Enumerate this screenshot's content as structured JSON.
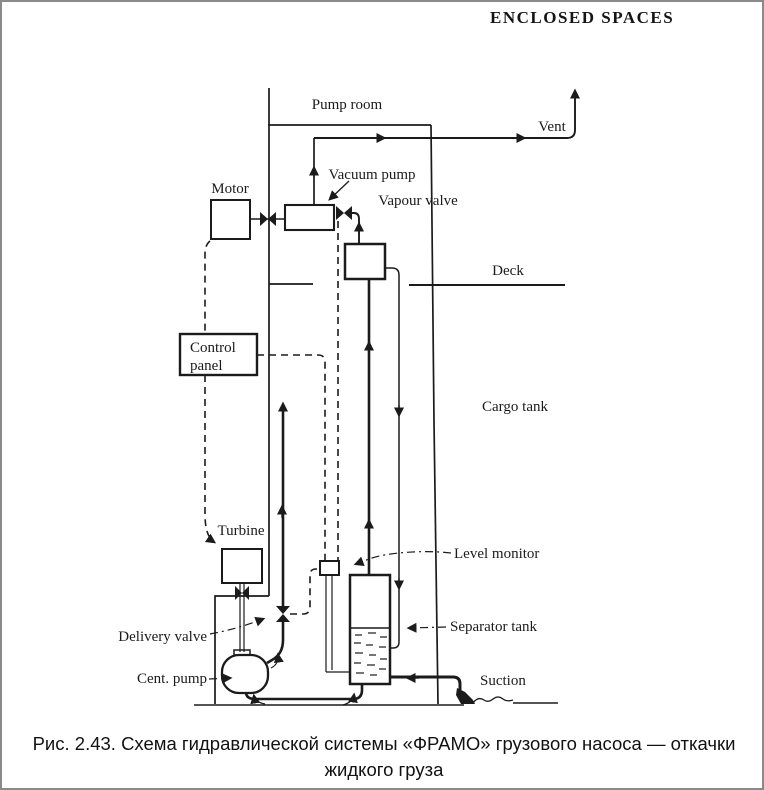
{
  "header": {
    "title": "ENCLOSED SPACES"
  },
  "diagram": {
    "ink_color": "#1b1b1b",
    "labels": {
      "pump_room": "Pump room",
      "vent": "Vent",
      "motor": "Motor",
      "vacuum_pump": "Vacuum pump",
      "vapour_valve": "Vapour valve",
      "deck": "Deck",
      "control_panel_line1": "Control",
      "control_panel_line2": "panel",
      "cargo_tank": "Cargo tank",
      "turbine": "Turbine",
      "level_monitor": "Level monitor",
      "delivery_valve": "Delivery valve",
      "separator_tank": "Separator tank",
      "cent_pump": "Cent. pump",
      "suction": "Suction"
    }
  },
  "caption": {
    "line1": "Рис. 2.43. Схема гидравлической системы «ФРАМО» грузового насоса — откачки",
    "line2": "жидкого груза"
  }
}
